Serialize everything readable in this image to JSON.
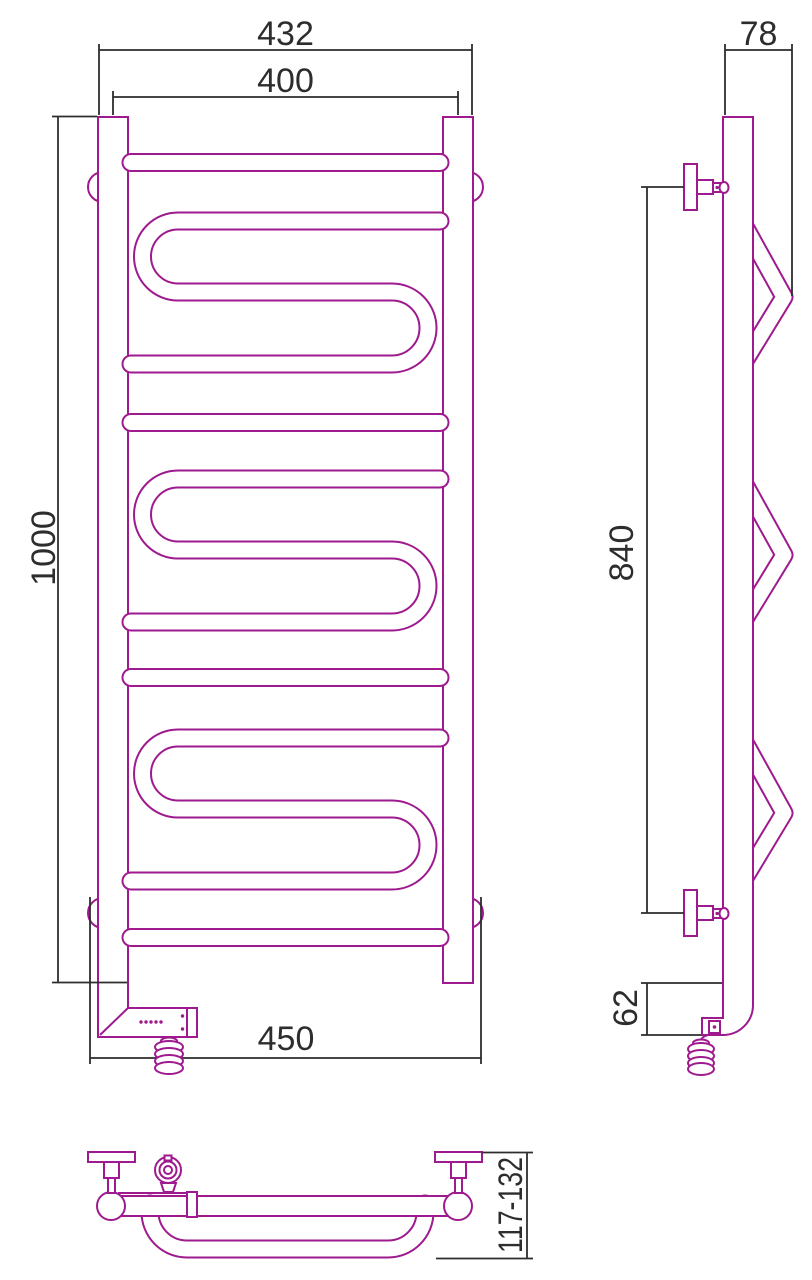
{
  "theme": {
    "product_color": "#9E1A8E",
    "dim_color": "#2D2D2D",
    "background": "#FFFFFF"
  },
  "dims": {
    "front": {
      "overall_width": "432",
      "center_width": "400",
      "height": "1000",
      "lower_width": "450"
    },
    "side": {
      "depth": "78",
      "bracket_spacing": "840",
      "lower_section": "62"
    },
    "bottom": {
      "wall_distance": "117-132"
    }
  }
}
